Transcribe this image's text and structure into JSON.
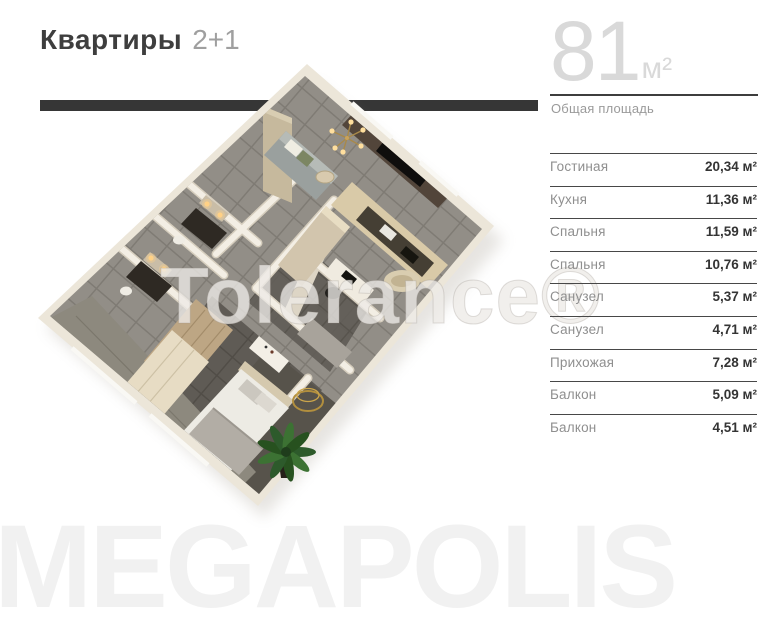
{
  "header": {
    "title": "Квартиры",
    "subtitle": "2+1"
  },
  "total_area": {
    "value": "81",
    "unit": "м²",
    "label": "Общая площадь"
  },
  "rooms": [
    {
      "name": "Гостиная",
      "area": "20,34 м²"
    },
    {
      "name": "Кухня",
      "area": "11,36 м²"
    },
    {
      "name": "Спальня",
      "area": "11,59 м²"
    },
    {
      "name": "Спальня",
      "area": "10,76 м²"
    },
    {
      "name": "Санузел",
      "area": "5,37 м²"
    },
    {
      "name": "Санузел",
      "area": "4,71 м²"
    },
    {
      "name": "Прихожая",
      "area": "7,28 м²"
    },
    {
      "name": "Балкон",
      "area": "5,09 м²"
    },
    {
      "name": "Балкон",
      "area": "4,51 м²"
    }
  ],
  "watermarks": {
    "plan": "Tolerance®",
    "brand": "MEGAPOLIS"
  },
  "colors": {
    "bar": "#363636",
    "title": "#3e3e3e",
    "muted_text": "#9a9a9a",
    "value_text": "#343434",
    "area_number": "#d9d9d9",
    "brand_watermark": "#f1f1f1"
  }
}
